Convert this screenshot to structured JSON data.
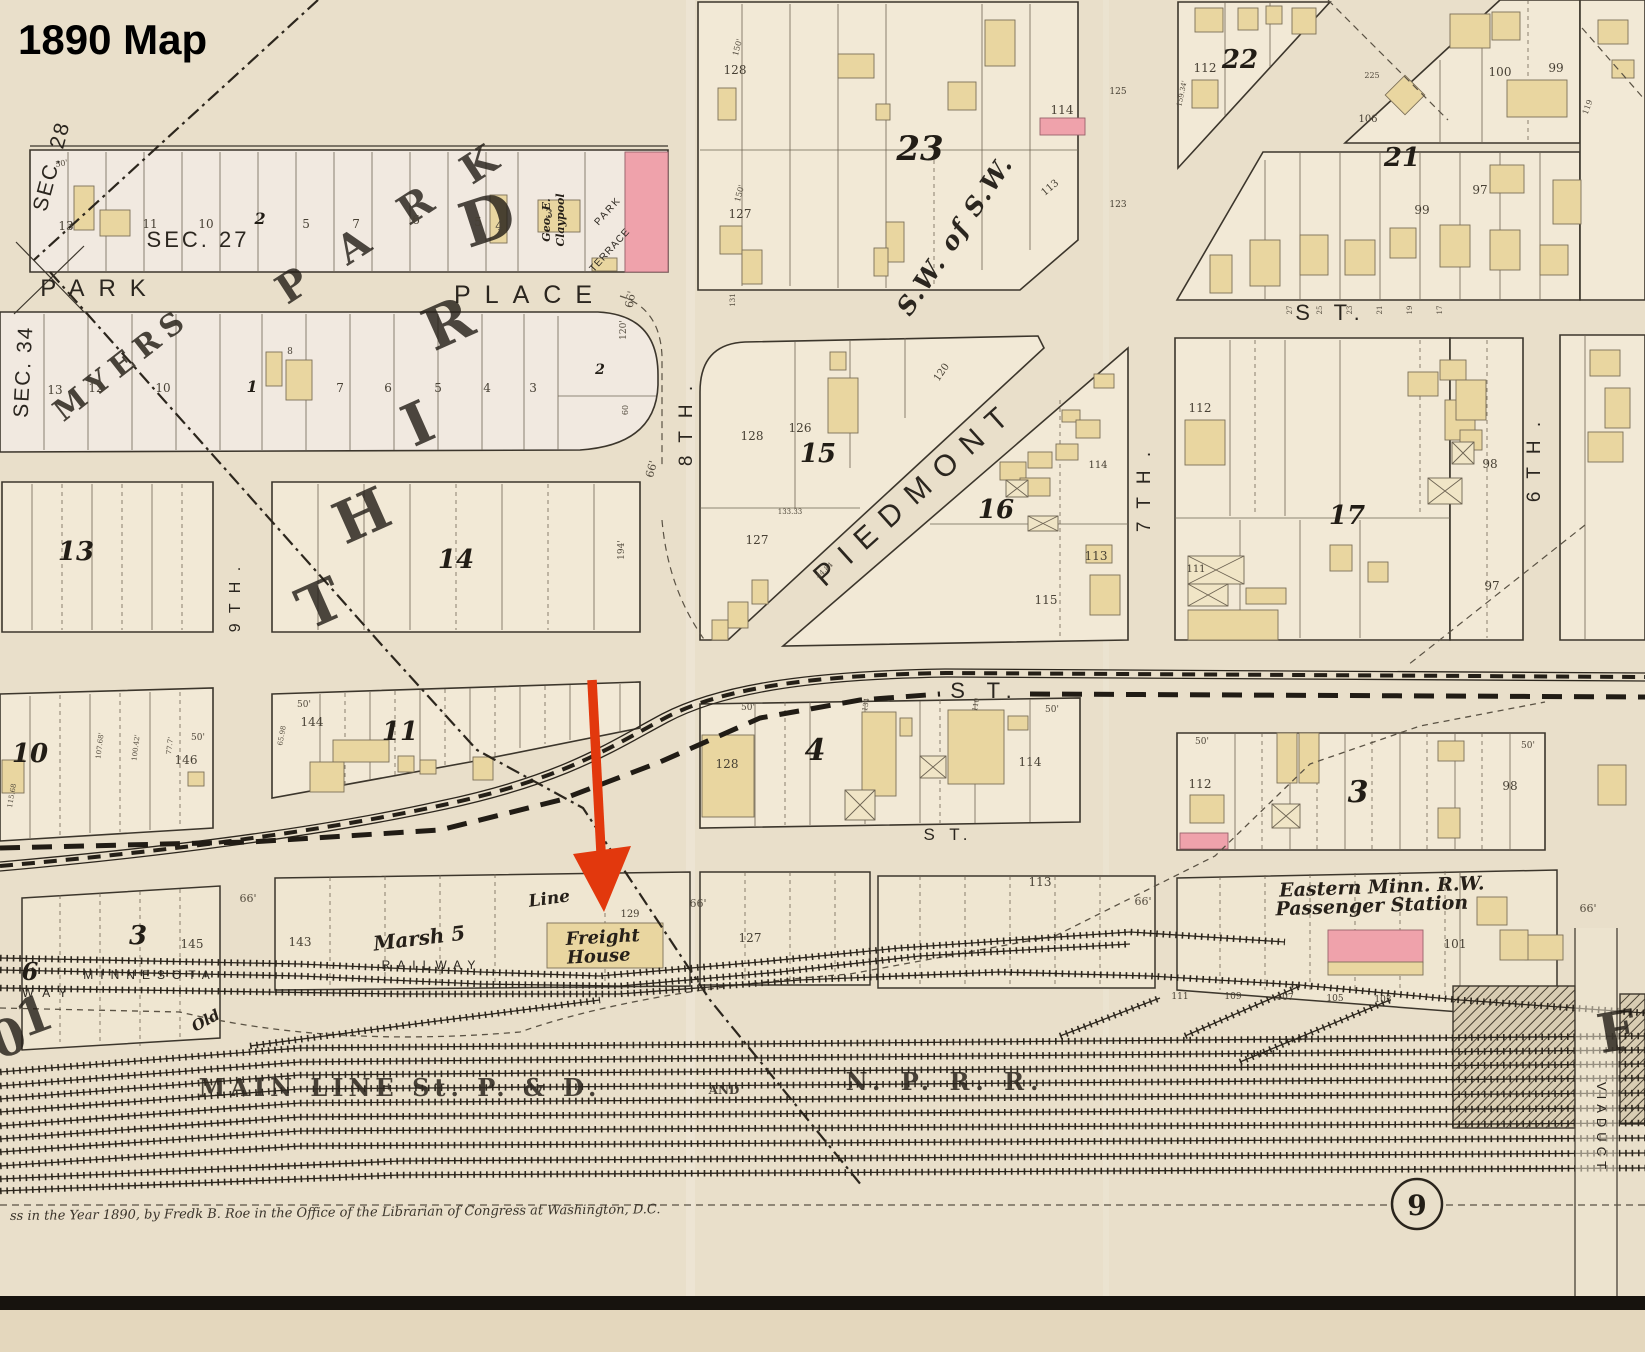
{
  "title": "1890 Map",
  "page_number": "9",
  "copyright": "ss in the Year 1890, by Fredk B. Roe in the Office of the Librarian of Congress at Washington, D.C.",
  "annotation": {
    "arrow_color": "#e2380d",
    "target_label": "Freight House"
  },
  "palette": {
    "paper": "#e9dfca",
    "block_fill": "#f2e9d6",
    "building_tan": "#e9d6a0",
    "building_pink": "#efa2ab",
    "ink": "#2c261d",
    "arrow_red": "#e2380d"
  },
  "map_labels": [
    {
      "t": "PARK",
      "x": 100,
      "y": 296,
      "s": 24,
      "ls": 14,
      "k": "street",
      "n": "street-label-park"
    },
    {
      "t": "PLACE",
      "x": 530,
      "y": 303,
      "s": 25,
      "ls": 14,
      "k": "street",
      "n": "street-label-place"
    },
    {
      "t": "S T.",
      "x": 1332,
      "y": 320,
      "s": 22,
      "ls": 9,
      "k": "street",
      "n": "street-label-st-top"
    },
    {
      "t": "S T.",
      "x": 985,
      "y": 698,
      "s": 22,
      "ls": 8,
      "k": "street",
      "n": "street-label-st-mid"
    },
    {
      "t": "S T.",
      "x": 948,
      "y": 840,
      "s": 17,
      "ls": 5,
      "k": "street",
      "n": "street-label-st-lower"
    },
    {
      "t": "PIEDMONT",
      "x": 922,
      "y": 500,
      "s": 30,
      "r": -42,
      "ls": 13,
      "k": "street",
      "n": "street-label-piedmont"
    },
    {
      "t": "8 T H .",
      "x": 692,
      "y": 424,
      "s": 19,
      "r": -90,
      "ls": 4,
      "k": "street",
      "n": "street-label-8th"
    },
    {
      "t": "9 T H .",
      "x": 240,
      "y": 598,
      "s": 16,
      "r": -90,
      "ls": 3,
      "k": "street",
      "n": "street-label-9th"
    },
    {
      "t": "7 T H .",
      "x": 1150,
      "y": 490,
      "s": 19,
      "r": -90,
      "ls": 4,
      "k": "street",
      "n": "street-label-7th"
    },
    {
      "t": "6 T H .",
      "x": 1540,
      "y": 460,
      "s": 19,
      "r": -90,
      "ls": 4,
      "k": "street",
      "n": "street-label-6th"
    },
    {
      "t": "SEC. 27",
      "x": 198,
      "y": 247,
      "s": 22,
      "ls": 3,
      "k": "street",
      "n": "section-label-27"
    },
    {
      "t": "SEC. 28",
      "x": 58,
      "y": 168,
      "s": 21,
      "r": -75,
      "ls": 2,
      "k": "street",
      "n": "section-label-28"
    },
    {
      "t": "SEC. 34",
      "x": 30,
      "y": 372,
      "s": 21,
      "r": -87,
      "ls": 2,
      "k": "street",
      "n": "section-label-34"
    },
    {
      "t": "S.W. of S.W.",
      "x": 962,
      "y": 240,
      "s": 25,
      "r": -56,
      "ls": 2,
      "k": "sw",
      "n": "quarter-section-label"
    },
    {
      "t": "MYERS",
      "x": 128,
      "y": 372,
      "s": 30,
      "r": -38,
      "ls": 8,
      "k": "giant2",
      "n": "division-label-myers"
    },
    {
      "t": "P A R K",
      "x": 400,
      "y": 232,
      "s": 40,
      "r": -33,
      "ls": 14,
      "k": "giant",
      "n": "division-letters-park"
    },
    {
      "t": "T",
      "x": 328,
      "y": 622,
      "s": 58,
      "r": -24,
      "k": "giant",
      "n": "division-letter-third-t"
    },
    {
      "t": "H",
      "x": 370,
      "y": 534,
      "s": 58,
      "r": -24,
      "k": "giant",
      "n": "division-letter-third-h"
    },
    {
      "t": "I",
      "x": 426,
      "y": 442,
      "s": 58,
      "r": -24,
      "k": "giant",
      "n": "division-letter-third-i"
    },
    {
      "t": "R",
      "x": 456,
      "y": 342,
      "s": 58,
      "r": -24,
      "k": "giant",
      "n": "division-letter-third-r"
    },
    {
      "t": "D",
      "x": 494,
      "y": 240,
      "s": 62,
      "r": -18,
      "k": "giant",
      "n": "division-letter-third-d"
    },
    {
      "t": "1",
      "x": 40,
      "y": 1032,
      "s": 50,
      "r": -20,
      "k": "giant"
    },
    {
      "t": "0",
      "x": 14,
      "y": 1054,
      "s": 50,
      "r": -20,
      "k": "giant"
    },
    {
      "t": "F",
      "x": 1620,
      "y": 1050,
      "s": 54,
      "r": -10,
      "k": "giant"
    },
    {
      "t": "MINNESOTA",
      "x": 150,
      "y": 979,
      "s": 12,
      "ls": 7,
      "k": "street",
      "n": "railway-label-minnesota"
    },
    {
      "t": "RAILWAY",
      "x": 432,
      "y": 969,
      "s": 12,
      "ls": 7,
      "k": "street",
      "n": "railway-label-railway"
    },
    {
      "t": "W A Y",
      "x": 46,
      "y": 997,
      "s": 12,
      "ls": 3,
      "k": "street"
    },
    {
      "t": "VIADUCT",
      "x": 1597,
      "y": 1128,
      "s": 13,
      "r": 90,
      "ls": 5,
      "k": "street",
      "n": "viaduct-label"
    },
    {
      "t": "Marsh 5",
      "x": 420,
      "y": 945,
      "s": 20,
      "r": -7,
      "k": "script",
      "n": "railway-label-marsh-5"
    },
    {
      "t": "Line",
      "x": 550,
      "y": 904,
      "s": 17,
      "r": -8,
      "k": "script"
    },
    {
      "t": "Old",
      "x": 208,
      "y": 1025,
      "s": 15,
      "r": -28,
      "k": "script"
    },
    {
      "t": "Freight",
      "x": 603,
      "y": 943,
      "s": 18,
      "r": -3,
      "k": "script",
      "n": "freight-house-label-1"
    },
    {
      "t": "House",
      "x": 599,
      "y": 962,
      "s": 18,
      "r": -3,
      "k": "script",
      "n": "freight-house-label-2"
    },
    {
      "t": "Eastern Minn. R.W.",
      "x": 1382,
      "y": 893,
      "s": 19,
      "r": -2,
      "k": "script",
      "n": "station-label-1"
    },
    {
      "t": "Passenger Station",
      "x": 1372,
      "y": 912,
      "s": 19,
      "r": -2,
      "k": "script",
      "n": "station-label-2"
    },
    {
      "t": "MAIN  LINE   St. P.  &  D.",
      "x": 400,
      "y": 1096,
      "s": 24,
      "ls": 5,
      "k": "rail2",
      "n": "main-line-label"
    },
    {
      "t": "AND",
      "x": 724,
      "y": 1094,
      "s": 12,
      "k": "rail2"
    },
    {
      "t": "N. P.   R. R.",
      "x": 945,
      "y": 1090,
      "s": 24,
      "ls": 6,
      "k": "rail2",
      "n": "npr-label"
    },
    {
      "t": "Geo. E.",
      "x": 550,
      "y": 220,
      "s": 11,
      "r": -90,
      "k": "script",
      "n": "owner-label-claypool"
    },
    {
      "t": "Claypool",
      "x": 564,
      "y": 220,
      "s": 11,
      "r": -90,
      "k": "script"
    },
    {
      "t": "PARK",
      "x": 610,
      "y": 213,
      "s": 10,
      "r": -48,
      "ls": 2,
      "k": "street",
      "n": "park-terrace-label"
    },
    {
      "t": "TERRACE",
      "x": 612,
      "y": 252,
      "s": 10,
      "r": -48,
      "ls": 1,
      "k": "street"
    },
    {
      "t": "23",
      "x": 920,
      "y": 160,
      "s": 34,
      "k": "blkn",
      "n": "block-number-23"
    },
    {
      "t": "22",
      "x": 1240,
      "y": 68,
      "s": 26,
      "k": "blkn",
      "n": "block-number-22"
    },
    {
      "t": "21",
      "x": 1402,
      "y": 166,
      "s": 26,
      "k": "blkn",
      "n": "block-number-21"
    },
    {
      "t": "15",
      "x": 818,
      "y": 462,
      "s": 26,
      "k": "blkn",
      "n": "block-number-15"
    },
    {
      "t": "16",
      "x": 996,
      "y": 518,
      "s": 26,
      "k": "blkn",
      "n": "block-number-16"
    },
    {
      "t": "17",
      "x": 1347,
      "y": 524,
      "s": 26,
      "k": "blkn",
      "n": "block-number-17"
    },
    {
      "t": "13",
      "x": 76,
      "y": 560,
      "s": 26,
      "k": "blkn",
      "n": "block-number-13"
    },
    {
      "t": "14",
      "x": 456,
      "y": 568,
      "s": 26,
      "k": "blkn",
      "n": "block-number-14"
    },
    {
      "t": "10",
      "x": 30,
      "y": 762,
      "s": 26,
      "k": "blkn",
      "n": "block-number-10"
    },
    {
      "t": "11",
      "x": 400,
      "y": 740,
      "s": 26,
      "k": "blkn",
      "n": "block-number-11"
    },
    {
      "t": "4",
      "x": 815,
      "y": 760,
      "s": 30,
      "k": "blkn",
      "n": "block-number-4"
    },
    {
      "t": "3",
      "x": 1358,
      "y": 802,
      "s": 30,
      "k": "blkn",
      "n": "block-number-3-east"
    },
    {
      "t": "3",
      "x": 138,
      "y": 944,
      "s": 26,
      "k": "blkn",
      "n": "block-number-3-west"
    },
    {
      "t": "6",
      "x": 30,
      "y": 980,
      "s": 24,
      "k": "blkn",
      "n": "block-number-6"
    },
    {
      "t": "2",
      "x": 260,
      "y": 224,
      "s": 16,
      "k": "blkn"
    },
    {
      "t": "1",
      "x": 252,
      "y": 392,
      "s": 16,
      "k": "blkn"
    },
    {
      "t": "2",
      "x": 600,
      "y": 374,
      "s": 14,
      "k": "blkn"
    },
    {
      "t": "13",
      "x": 66,
      "y": 230
    },
    {
      "t": "11",
      "x": 150,
      "y": 228
    },
    {
      "t": "10",
      "x": 206,
      "y": 228
    },
    {
      "t": "5",
      "x": 306,
      "y": 228
    },
    {
      "t": "7",
      "x": 356,
      "y": 228
    },
    {
      "t": "6",
      "x": 416,
      "y": 224
    },
    {
      "t": "5",
      "x": 478,
      "y": 226
    },
    {
      "t": "4",
      "x": 499,
      "y": 230
    },
    {
      "t": "3",
      "x": 549,
      "y": 218
    },
    {
      "t": "13",
      "x": 55,
      "y": 394
    },
    {
      "t": "12",
      "x": 96,
      "y": 392
    },
    {
      "t": "10",
      "x": 163,
      "y": 392
    },
    {
      "t": "8",
      "x": 290,
      "y": 354,
      "s": 9
    },
    {
      "t": "7",
      "x": 340,
      "y": 392
    },
    {
      "t": "6",
      "x": 388,
      "y": 392
    },
    {
      "t": "5",
      "x": 438,
      "y": 392
    },
    {
      "t": "4",
      "x": 487,
      "y": 392
    },
    {
      "t": "3",
      "x": 533,
      "y": 392
    },
    {
      "t": "128",
      "x": 735,
      "y": 74
    },
    {
      "t": "127",
      "x": 740,
      "y": 218
    },
    {
      "t": "114",
      "x": 1062,
      "y": 114
    },
    {
      "t": "113",
      "x": 1052,
      "y": 190,
      "r": -40,
      "s": 10
    },
    {
      "t": "112",
      "x": 1205,
      "y": 72
    },
    {
      "t": "100",
      "x": 1500,
      "y": 76
    },
    {
      "t": "99",
      "x": 1556,
      "y": 72
    },
    {
      "t": "106",
      "x": 1368,
      "y": 122,
      "s": 10
    },
    {
      "t": "99",
      "x": 1422,
      "y": 214
    },
    {
      "t": "97",
      "x": 1480,
      "y": 194
    },
    {
      "t": "128",
      "x": 752,
      "y": 440
    },
    {
      "t": "126",
      "x": 800,
      "y": 432
    },
    {
      "t": "120",
      "x": 944,
      "y": 374,
      "r": -55,
      "s": 10
    },
    {
      "t": "127",
      "x": 757,
      "y": 544
    },
    {
      "t": "114",
      "x": 1098,
      "y": 468,
      "s": 10
    },
    {
      "t": "113",
      "x": 1096,
      "y": 560
    },
    {
      "t": "115",
      "x": 1046,
      "y": 604
    },
    {
      "t": "112",
      "x": 1200,
      "y": 412
    },
    {
      "t": "111",
      "x": 1196,
      "y": 572,
      "s": 10
    },
    {
      "t": "98",
      "x": 1490,
      "y": 468
    },
    {
      "t": "97",
      "x": 1492,
      "y": 590
    },
    {
      "t": "146",
      "x": 186,
      "y": 764
    },
    {
      "t": "144",
      "x": 312,
      "y": 726
    },
    {
      "t": "128",
      "x": 727,
      "y": 768
    },
    {
      "t": "114",
      "x": 1030,
      "y": 766
    },
    {
      "t": "112",
      "x": 1200,
      "y": 788
    },
    {
      "t": "98",
      "x": 1510,
      "y": 790
    },
    {
      "t": "145",
      "x": 192,
      "y": 948
    },
    {
      "t": "143",
      "x": 300,
      "y": 946
    },
    {
      "t": "129",
      "x": 630,
      "y": 917,
      "s": 10
    },
    {
      "t": "127",
      "x": 750,
      "y": 942
    },
    {
      "t": "113",
      "x": 1040,
      "y": 886
    },
    {
      "t": "101",
      "x": 1455,
      "y": 948
    },
    {
      "t": "111",
      "x": 1180,
      "y": 999,
      "s": 9
    },
    {
      "t": "109",
      "x": 1233,
      "y": 999,
      "s": 9
    },
    {
      "t": "107",
      "x": 1285,
      "y": 1000,
      "s": 9
    },
    {
      "t": "105",
      "x": 1335,
      "y": 1001,
      "s": 9
    },
    {
      "t": "103",
      "x": 1383,
      "y": 1002,
      "s": 9
    },
    {
      "t": "125",
      "x": 1118,
      "y": 94,
      "s": 9
    },
    {
      "t": "123",
      "x": 1118,
      "y": 207,
      "s": 9
    },
    {
      "t": "50'",
      "x": 198,
      "y": 740,
      "s": 9,
      "k": "dim"
    },
    {
      "t": "50'",
      "x": 304,
      "y": 707,
      "s": 9,
      "k": "dim"
    },
    {
      "t": "50'",
      "x": 748,
      "y": 710,
      "s": 9,
      "k": "dim"
    },
    {
      "t": "50'",
      "x": 1052,
      "y": 712,
      "s": 9,
      "k": "dim"
    },
    {
      "t": "50'",
      "x": 1202,
      "y": 744,
      "s": 9,
      "k": "dim"
    },
    {
      "t": "50'",
      "x": 1528,
      "y": 748,
      "s": 9,
      "k": "dim"
    },
    {
      "t": "50'",
      "x": 62,
      "y": 166,
      "s": 8,
      "r": -10,
      "k": "dim"
    },
    {
      "t": "150'",
      "x": 740,
      "y": 48,
      "s": 8,
      "r": -75,
      "k": "dim"
    },
    {
      "t": "150'",
      "x": 742,
      "y": 194,
      "s": 8,
      "r": -75,
      "k": "dim"
    },
    {
      "t": "66'",
      "x": 634,
      "y": 300,
      "s": 11,
      "r": -80,
      "k": "dim"
    },
    {
      "t": "66'",
      "x": 655,
      "y": 470,
      "s": 11,
      "r": -75,
      "k": "dim"
    },
    {
      "t": "66'",
      "x": 248,
      "y": 902,
      "s": 11,
      "k": "dim"
    },
    {
      "t": "66'",
      "x": 698,
      "y": 907,
      "s": 11,
      "k": "dim"
    },
    {
      "t": "66'",
      "x": 1143,
      "y": 905,
      "s": 11,
      "k": "dim"
    },
    {
      "t": "66'",
      "x": 1588,
      "y": 912,
      "s": 11,
      "k": "dim"
    },
    {
      "t": "120'",
      "x": 626,
      "y": 330,
      "s": 9,
      "r": -90,
      "k": "dim"
    },
    {
      "t": "60",
      "x": 628,
      "y": 410,
      "s": 8,
      "r": -90,
      "k": "dim"
    },
    {
      "t": "194'",
      "x": 624,
      "y": 550,
      "s": 9,
      "r": -90,
      "k": "dim"
    },
    {
      "t": "159.34'",
      "x": 1184,
      "y": 94,
      "s": 7,
      "r": -78,
      "k": "dim"
    },
    {
      "t": "119",
      "x": 1590,
      "y": 108,
      "s": 8,
      "r": -70,
      "k": "dim"
    },
    {
      "t": "225",
      "x": 1372,
      "y": 78,
      "s": 8,
      "k": "dim"
    },
    {
      "t": "107.68'",
      "x": 102,
      "y": 746,
      "s": 7,
      "r": -83,
      "k": "dim"
    },
    {
      "t": "100.42'",
      "x": 138,
      "y": 748,
      "s": 7,
      "r": -83,
      "k": "dim"
    },
    {
      "t": "77.7'",
      "x": 172,
      "y": 746,
      "s": 7,
      "r": -83,
      "k": "dim"
    },
    {
      "t": "115.68",
      "x": 14,
      "y": 796,
      "s": 7,
      "r": -80,
      "k": "dim"
    },
    {
      "t": "65.98",
      "x": 284,
      "y": 736,
      "s": 7,
      "r": -80,
      "k": "dim"
    },
    {
      "t": "133.33",
      "x": 790,
      "y": 514,
      "s": 7,
      "k": "dim"
    },
    {
      "t": "44.84",
      "x": 826,
      "y": 572,
      "s": 7,
      "r": -43,
      "k": "dim"
    },
    {
      "t": "27",
      "x": 1292,
      "y": 310,
      "s": 7,
      "r": -90,
      "k": "dim"
    },
    {
      "t": "25",
      "x": 1322,
      "y": 310,
      "s": 7,
      "r": -90,
      "k": "dim"
    },
    {
      "t": "23",
      "x": 1352,
      "y": 310,
      "s": 7,
      "r": -90,
      "k": "dim"
    },
    {
      "t": "21",
      "x": 1382,
      "y": 310,
      "s": 7,
      "r": -90,
      "k": "dim"
    },
    {
      "t": "19",
      "x": 1412,
      "y": 310,
      "s": 7,
      "r": -90,
      "k": "dim"
    },
    {
      "t": "17",
      "x": 1442,
      "y": 310,
      "s": 7,
      "r": -90,
      "k": "dim"
    },
    {
      "t": "131",
      "x": 735,
      "y": 300,
      "s": 7,
      "r": -90,
      "k": "dim"
    },
    {
      "t": "134",
      "x": 868,
      "y": 705,
      "s": 7,
      "r": -80,
      "k": "dim"
    },
    {
      "t": "110",
      "x": 978,
      "y": 705,
      "s": 7,
      "r": -80,
      "k": "dim"
    }
  ]
}
